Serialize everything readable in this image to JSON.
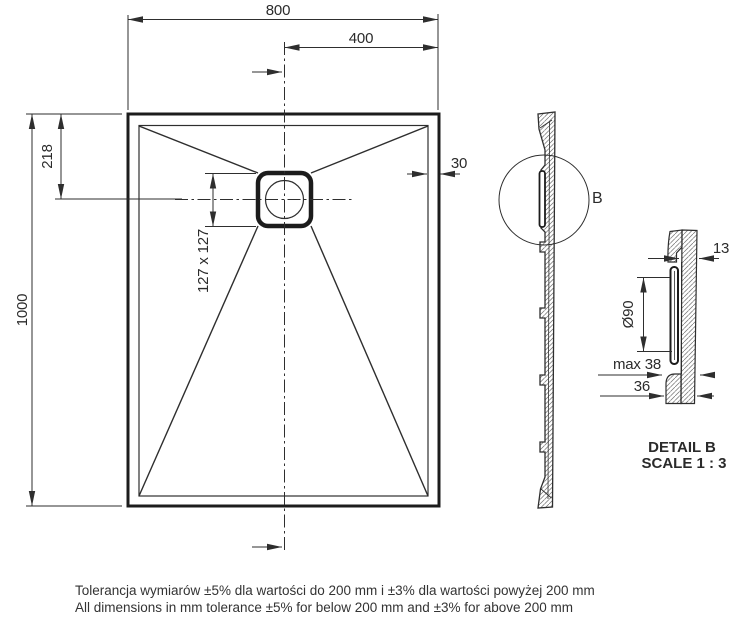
{
  "drawing": {
    "title": "shower-tray-technical-drawing",
    "top_view": {
      "dim_width": "800",
      "dim_half_width": "400",
      "dim_drain_offset": "218",
      "dim_length": "1000",
      "dim_drain_square": "127 x 127",
      "dim_rim_width": "30"
    },
    "side_view": {
      "detail_label": "B"
    },
    "detail_view": {
      "dim_edge_thickness": "13",
      "dim_drain_diameter": "Ø90",
      "dim_max_depth": "max 38",
      "dim_base_height": "36",
      "title": "DETAIL B",
      "scale": "SCALE 1 : 3"
    },
    "notes": {
      "line1_pl": "Tolerancja wymiarów ±5% dla wartości do 200 mm i ±3% dla wartości powyżej 200 mm",
      "line2_en": "All dimensions in mm tolerance ±5% for below 200 mm and ±3% for above 200 mm"
    },
    "colors": {
      "line": "#2e2e2e",
      "bold_line": "#1c1c1c",
      "background": "#ffffff"
    }
  }
}
